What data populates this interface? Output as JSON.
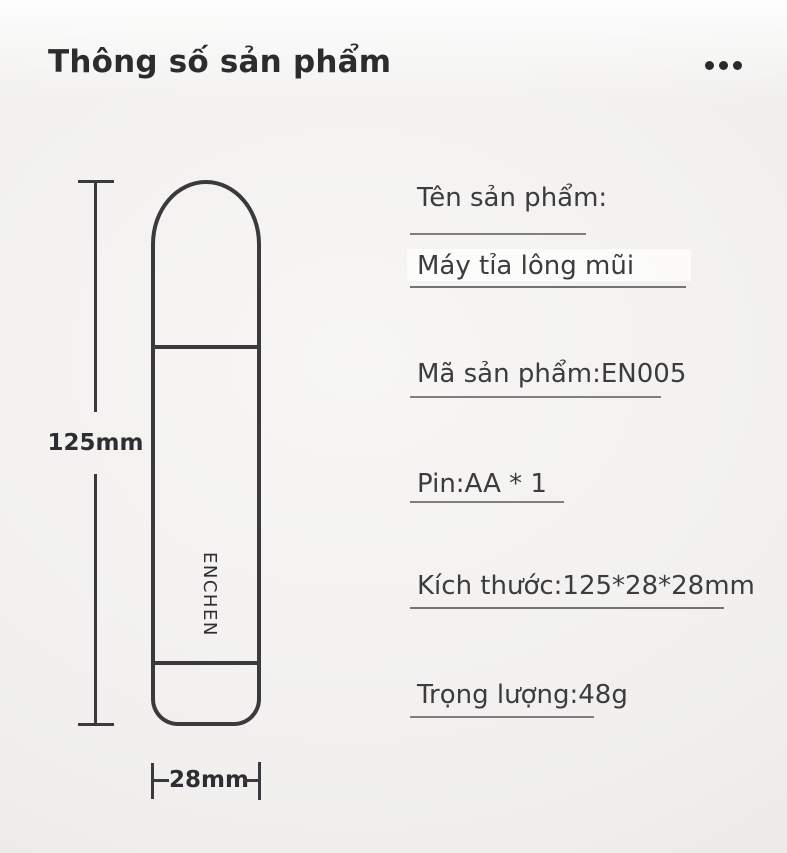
{
  "header": {
    "title": "Thông số sản phẩm",
    "menu_icon": "ellipsis-icon"
  },
  "diagram": {
    "brand": "ENCHEN",
    "height_label": "125mm",
    "width_label": "28mm"
  },
  "specs": {
    "rows": [
      {
        "id": "product-name-label",
        "text": "Tên sản phẩm:"
      },
      {
        "id": "product-name-value",
        "text": "Máy tỉa lông mũi",
        "highlighted": true
      },
      {
        "id": "product-code",
        "text": "Mã sản phẩm:EN005"
      },
      {
        "id": "battery",
        "text": "Pin:AA * 1"
      },
      {
        "id": "dimensions",
        "text": "Kích thước:125*28*28mm"
      },
      {
        "id": "weight",
        "text": "Trọng lượng:48g"
      }
    ]
  },
  "colors": {
    "background_center": "#f5f4f3",
    "background_edge": "#e8e6e4",
    "title_text": "#2c2c2e",
    "spec_text": "#3c3c3e",
    "drawing_line": "#3a393c",
    "underline": "#7f7f82",
    "highlight_box": "#fdfdfc"
  }
}
